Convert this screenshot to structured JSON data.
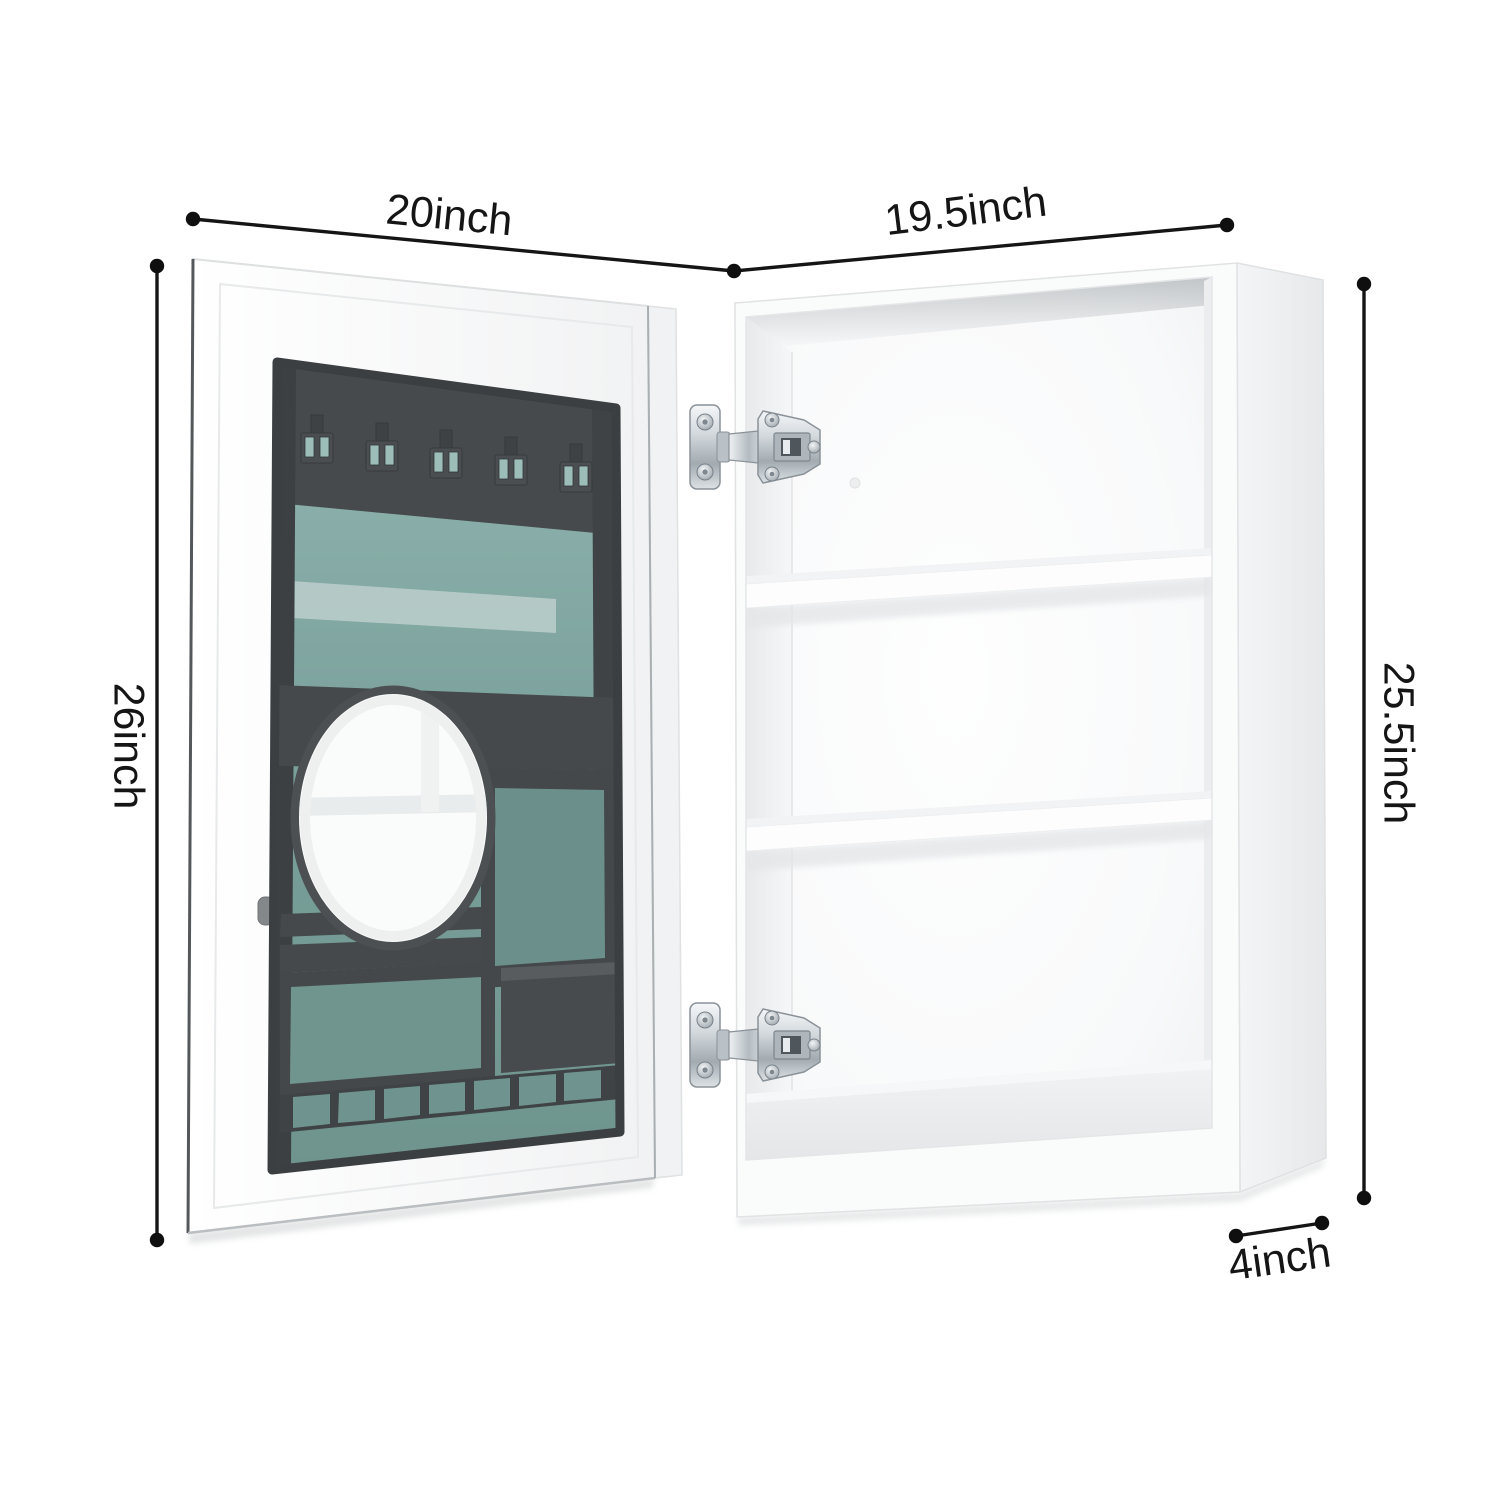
{
  "figure": {
    "kind": "product dimension diagram",
    "subject": "wall medicine cabinet shown open: storage door with organizer and mirrored oval insert on the left, shelved cabinet body on the right",
    "background_color": "#ffffff"
  },
  "dimension_labels": {
    "door_width": "20inch",
    "body_width": "19.5inch",
    "door_height": "26inch",
    "body_height": "25.5inch",
    "body_depth": "4inch"
  },
  "style": {
    "annotation_color": "#151515",
    "glass_teal": "#84aaa5",
    "organizer_gray": "#45494b",
    "cabinet_white": "#fafbfb",
    "chrome": "#c9d0d5"
  }
}
